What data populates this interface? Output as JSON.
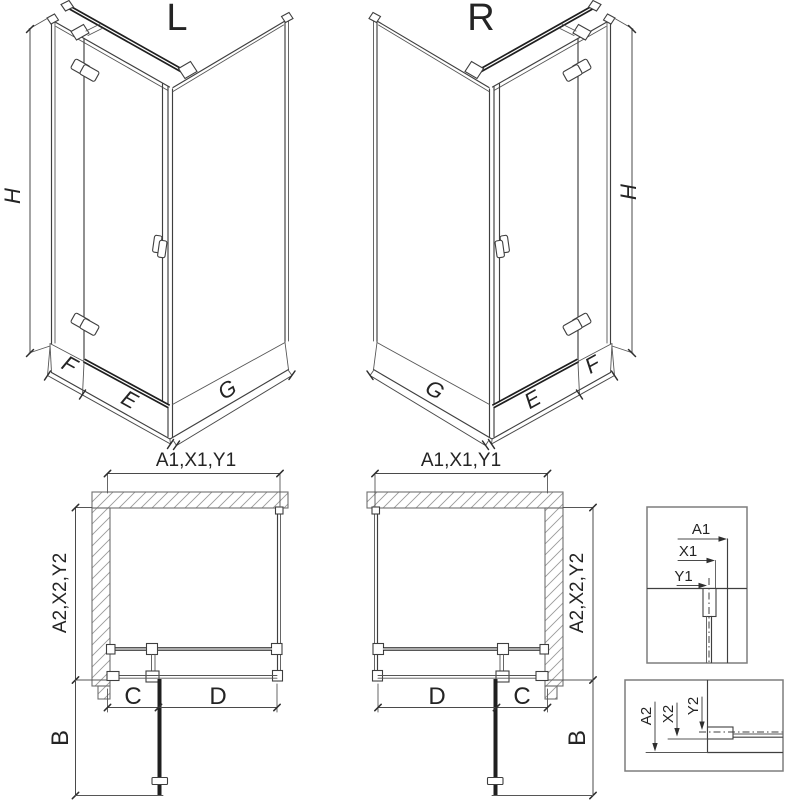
{
  "colors": {
    "background": "#ffffff",
    "line": "#3f3f3f",
    "thick_line": "#1f1f1f",
    "hatch": "#9a9a9a",
    "detail_frame": "#7d7d7d",
    "text": "#242424"
  },
  "iso_left": {
    "title": "L",
    "height_dim": "H",
    "fixed_panel_dim": "F",
    "door_wall_dim": "E",
    "side_wall_dim": "G"
  },
  "iso_right": {
    "title": "R",
    "height_dim": "H",
    "fixed_panel_dim": "F",
    "door_wall_dim": "E",
    "side_wall_dim": "G"
  },
  "plan_left": {
    "width_dim": "A1,X1,Y1",
    "depth_dim": "A2,X2,Y2",
    "segment_c": "C",
    "segment_d": "D",
    "door_swing_dim": "B"
  },
  "plan_right": {
    "width_dim": "A1,X1,Y1",
    "depth_dim": "A2,X2,Y2",
    "segment_c": "C",
    "segment_d": "D",
    "door_swing_dim": "B"
  },
  "detail_width": {
    "outer_dim": "A1",
    "profile_dim": "X1",
    "axis_dim": "Y1"
  },
  "detail_depth": {
    "outer_dim": "A2",
    "profile_dim": "X2",
    "axis_dim": "Y2"
  }
}
